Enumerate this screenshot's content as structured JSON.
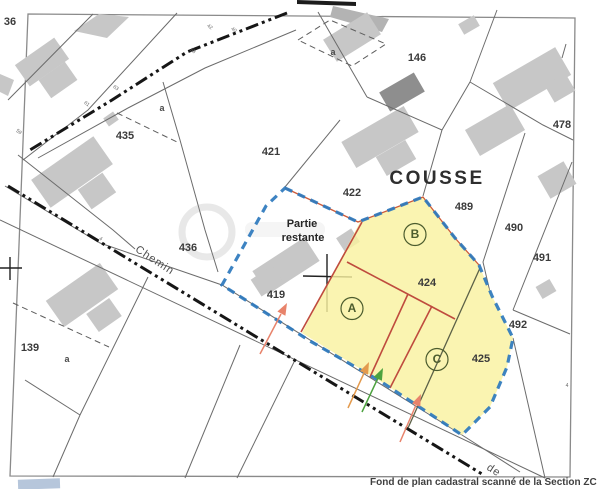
{
  "map": {
    "title": "Plan cadastral",
    "place_name": "COUSSE",
    "caption": "Fond de plan cadastral scanné de la Section ZC",
    "remaining_part": "Partie restante",
    "road_name": "Chemin",
    "road_name_fragment": "de",
    "highlighted_parcels": [
      "424",
      "425"
    ],
    "lot_letters": [
      "A",
      "B",
      "C"
    ]
  },
  "labels": [
    {
      "name": "parcel-36",
      "text": "36",
      "x": 10,
      "y": 25,
      "cls": "num"
    },
    {
      "name": "parcel-435",
      "text": "435",
      "x": 125,
      "y": 139,
      "cls": "num"
    },
    {
      "name": "subparcel-a-435",
      "text": "a",
      "x": 162,
      "y": 111,
      "cls": "small"
    },
    {
      "name": "subparcel-a-top",
      "text": "a",
      "x": 333,
      "y": 55,
      "cls": "small"
    },
    {
      "name": "parcel-146",
      "text": "146",
      "x": 417,
      "y": 61,
      "cls": "num"
    },
    {
      "name": "parcel-478",
      "text": "478",
      "x": 562,
      "y": 128,
      "cls": "num"
    },
    {
      "name": "parcel-421",
      "text": "421",
      "x": 271,
      "y": 155,
      "cls": "num"
    },
    {
      "name": "parcel-422",
      "text": "422",
      "x": 352,
      "y": 196,
      "cls": "num"
    },
    {
      "name": "place-cousse",
      "text": "COUSSE",
      "x": 437,
      "y": 184,
      "cls": "place"
    },
    {
      "name": "parcel-489",
      "text": "489",
      "x": 464,
      "y": 210,
      "cls": "num"
    },
    {
      "name": "parcel-490",
      "text": "490",
      "x": 514,
      "y": 231,
      "cls": "num"
    },
    {
      "name": "parcel-491",
      "text": "491",
      "x": 542,
      "y": 261,
      "cls": "num"
    },
    {
      "name": "parcel-492",
      "text": "492",
      "x": 518,
      "y": 328,
      "cls": "num"
    },
    {
      "name": "parcel-424",
      "text": "424",
      "x": 427,
      "y": 286,
      "cls": "num"
    },
    {
      "name": "parcel-425",
      "text": "425",
      "x": 481,
      "y": 362,
      "cls": "num"
    },
    {
      "name": "parcel-419",
      "text": "419",
      "x": 276,
      "y": 298,
      "cls": "num"
    },
    {
      "name": "parcel-436",
      "text": "436",
      "x": 188,
      "y": 251,
      "cls": "num"
    },
    {
      "name": "parcel-139",
      "text": "139",
      "x": 30,
      "y": 351,
      "cls": "num"
    },
    {
      "name": "subparcel-a-139",
      "text": "a",
      "x": 67,
      "y": 362,
      "cls": "small"
    },
    {
      "name": "label-partie",
      "text": "Partie",
      "x": 302,
      "y": 227,
      "cls": "text"
    },
    {
      "name": "label-restante",
      "text": "restante",
      "x": 303,
      "y": 241,
      "cls": "text"
    },
    {
      "name": "road-label-chemin",
      "text": "Chemin",
      "x": 153,
      "y": 263,
      "cls": "road",
      "rot": 33
    },
    {
      "name": "road-label-de",
      "text": "de",
      "x": 492,
      "y": 473,
      "cls": "road",
      "rot": 33
    },
    {
      "name": "lot-letter-b",
      "text": "B",
      "x": 415,
      "y": 238,
      "cls": "letter",
      "circle": 11
    },
    {
      "name": "lot-letter-a",
      "text": "A",
      "x": 352,
      "y": 312,
      "cls": "letter",
      "circle": 11
    },
    {
      "name": "lot-letter-c",
      "text": "C",
      "x": 437,
      "y": 363,
      "cls": "letter",
      "circle": 11
    },
    {
      "name": "road-marker-59",
      "text": "59",
      "x": 18,
      "y": 133,
      "cls": "tiny",
      "rot": 35
    },
    {
      "name": "road-marker-61",
      "text": "61",
      "x": 86,
      "y": 105,
      "cls": "tiny",
      "rot": 35
    },
    {
      "name": "road-marker-63",
      "text": "63",
      "x": 115,
      "y": 89,
      "cls": "tiny",
      "rot": 35
    },
    {
      "name": "road-marker-58",
      "text": "58",
      "x": 192,
      "y": 52,
      "cls": "tiny",
      "rot": 35
    },
    {
      "name": "road-marker-42",
      "text": "42",
      "x": 209,
      "y": 28,
      "cls": "tiny",
      "rot": 35
    },
    {
      "name": "road-marker-40",
      "text": "40",
      "x": 233,
      "y": 31,
      "cls": "tiny",
      "rot": 35
    },
    {
      "name": "road-marker-4",
      "text": "4",
      "x": 100,
      "y": 240,
      "cls": "tiny",
      "rot": 33
    },
    {
      "name": "parcel-4-partial",
      "text": "4",
      "x": 567,
      "y": 387,
      "cls": "tiny"
    }
  ],
  "colors": {
    "highlight_fill": "#f9f2a0",
    "boundary_blue": "#2c78bd",
    "division_red": "#bf4b3e",
    "underlay_orange": "#cc5a3a",
    "arrow_orange": "#e39a4d",
    "arrow_green": "#4ca23e",
    "arrow_salmon": "#e8836b",
    "building_gray": "#c7c7c7",
    "building_dark": "#8e8e8e",
    "line_gray": "#6b6b6b",
    "old_boundary_olive": "#5c6147"
  }
}
